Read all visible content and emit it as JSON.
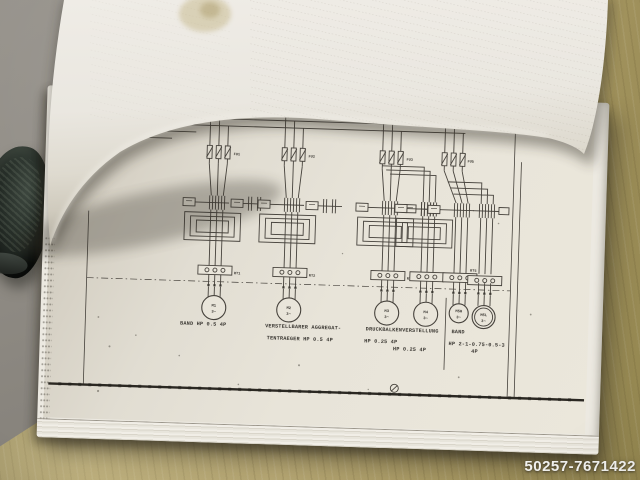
{
  "photo": {
    "watermark": "50257-7671422"
  },
  "schematic": {
    "fuses": [
      {
        "label": "FU1"
      },
      {
        "label": "FU2"
      },
      {
        "label": "FU3"
      },
      {
        "label": "FU5"
      }
    ],
    "relays": [
      {
        "label": "RT1"
      },
      {
        "label": "RT2"
      },
      {
        "label": "RT3"
      },
      {
        "label": "RT4"
      },
      {
        "label": "RT5"
      }
    ],
    "motors": [
      {
        "name": "M1",
        "phase": "3~"
      },
      {
        "name": "M2",
        "phase": "3~"
      },
      {
        "name": "M3",
        "phase": "3~"
      },
      {
        "name": "M4",
        "phase": "3~"
      },
      {
        "name": "M5H",
        "phase": "3~"
      },
      {
        "name": "M5L",
        "phase": "3~"
      }
    ],
    "captions": {
      "band1": "BAND  HP 0.5  4P",
      "verstell1": "VERSTELLBARER AGGREGAT-",
      "verstell2": "TENTRAEGER HP 0.5 4P",
      "druck1": "DRUCKBALKENVERSTELLUNG",
      "druck2": "HP 0.25 4P",
      "druck3": "HP 0.25 4P",
      "band2_1": "BAND",
      "band2_2": "HP 2-1-0.75-0.5-3",
      "band2_3": "4P"
    }
  }
}
